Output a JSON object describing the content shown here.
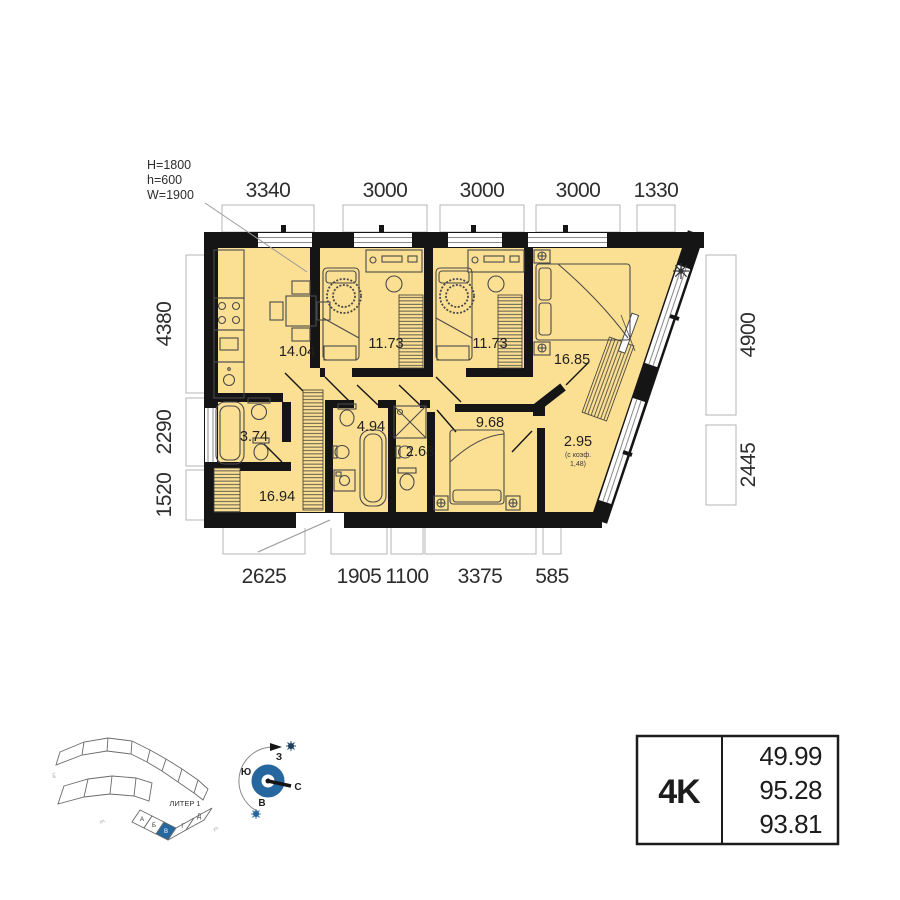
{
  "plan": {
    "window_note": {
      "l1": "H=1800",
      "l2": "h=600",
      "l3": "W=1900"
    },
    "dims_top": [
      "3340",
      "3000",
      "3000",
      "3000",
      "1330"
    ],
    "dims_left": [
      "4380",
      "2290",
      "1520"
    ],
    "dims_right": [
      "4900",
      "2445"
    ],
    "dims_bottom": [
      "2625",
      "1905",
      "1100",
      "3375",
      "585"
    ],
    "areas": {
      "kitchen": "14.04",
      "room1": "11.73",
      "room2": "11.73",
      "bedroom": "16.85",
      "bath": "3.74",
      "hall": "16.94",
      "bath2": "4.94",
      "shower": "2.68",
      "living": "9.68",
      "loggia": "2.95",
      "loggia_note1": "(с коэф.",
      "loggia_note2": "1,48)"
    }
  },
  "summary": {
    "type": "4K",
    "living_area": "49.99",
    "total_area": "95.28",
    "reduced_area": "93.81"
  },
  "compass": {
    "n": "С",
    "s": "Ю",
    "w": "З",
    "e": "В"
  },
  "siteplan": {
    "label": "ЛИТЕР 1",
    "sections": [
      "А",
      "Б",
      "В",
      "Г",
      "Д"
    ],
    "streets": [
      "ул.",
      "ул.",
      "ул."
    ]
  },
  "colors": {
    "room_fill": "#FBDF92",
    "wall": "#151515",
    "accent_blue": "#27679F"
  }
}
